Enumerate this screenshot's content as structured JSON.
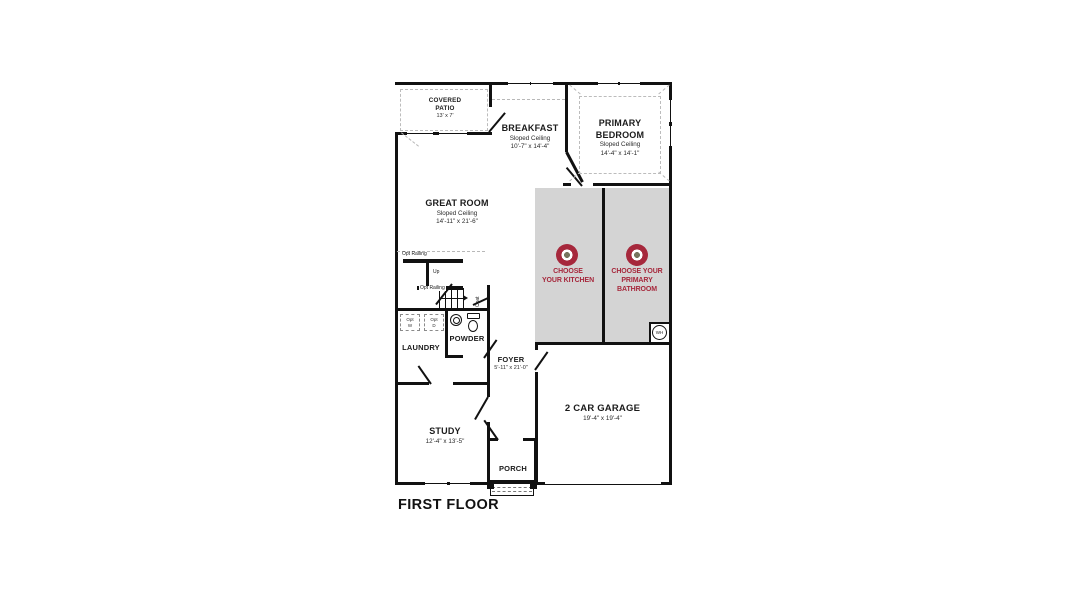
{
  "title": "FIRST FLOOR",
  "rooms": {
    "covered_patio": {
      "name": "COVERED PATIO",
      "dims": "13' x 7'"
    },
    "breakfast": {
      "name": "BREAKFAST",
      "ceiling": "Sloped Ceiling",
      "dims": "10'-7\" x 14'-4\""
    },
    "primary_bedroom": {
      "name": "PRIMARY BEDROOM",
      "ceiling": "Sloped Ceiling",
      "dims": "14'-4\" x 14'-1\""
    },
    "great_room": {
      "name": "GREAT ROOM",
      "ceiling": "Sloped Ceiling",
      "dims": "14'-11\" x 21'-6\""
    },
    "laundry": {
      "name": "LAUNDRY"
    },
    "powder": {
      "name": "POWDER"
    },
    "foyer": {
      "name": "FOYER",
      "dims": "5'-11\" x 21'-0\""
    },
    "study": {
      "name": "STUDY",
      "dims": "12'-4\" x 13'-5\""
    },
    "porch": {
      "name": "PORCH"
    },
    "garage": {
      "name": "2 CAR GARAGE",
      "dims": "19'-4\" x 19'-4\""
    }
  },
  "cta": {
    "kitchen": {
      "line1": "CHOOSE",
      "line2": "YOUR KITCHEN"
    },
    "bathroom": {
      "line1": "CHOOSE YOUR",
      "line2": "PRIMARY BATHROOM"
    }
  },
  "annotations": {
    "opt_railing": "Opt Railing",
    "up": "Up",
    "coat": "Coat",
    "washer": {
      "line1": "Opt",
      "line2": "W"
    },
    "dryer": {
      "line1": "Opt",
      "line2": "D"
    },
    "water_heater": "WH"
  },
  "colors": {
    "accent_red": "#A6283C",
    "highlight_gray": "#D4D4D4",
    "wall_black": "#111111"
  }
}
